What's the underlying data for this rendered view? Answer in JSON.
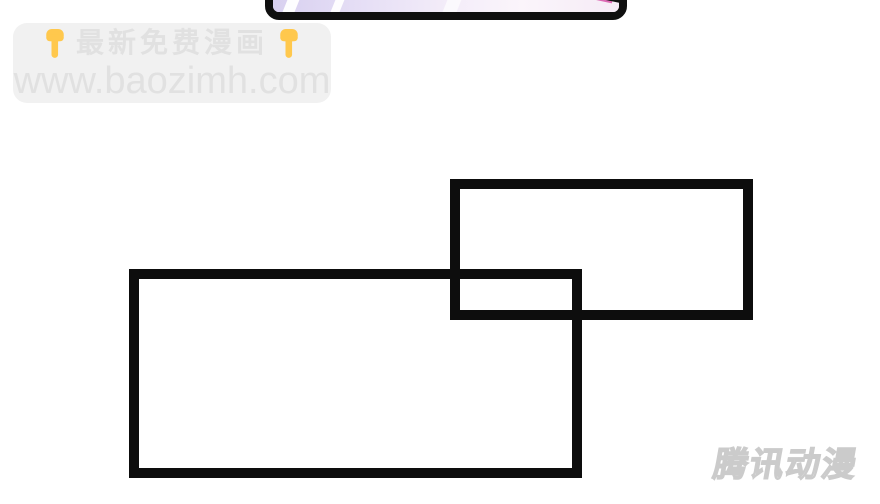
{
  "page": {
    "background_color": "#ffffff",
    "content_type": "manhua-comic-page"
  },
  "top_panel": {
    "description": "partially visible comic panel cropped by top edge",
    "border_color": "#0f0f0f",
    "art_colors": {
      "lavender": "#d8d0f0",
      "pale_pink": "#fbf5fb",
      "stripe_white": "#ffffff",
      "accent_pink": "#dc6ab4",
      "wedge_black": "#101010"
    }
  },
  "promo_banner": {
    "background_color": "#f1f1f1",
    "text_color": "#e1e1e1",
    "left_icon": "point-down-hand",
    "right_icon": "point-down-hand",
    "hand_color": "#ffc84d",
    "headline": "最新免费漫画",
    "url": "www.baozimh.com"
  },
  "comic_frames": {
    "border_color": "#0d0d0d",
    "right_frame_content": "",
    "left_frame_content": ""
  },
  "publisher_watermark": {
    "text": "腾讯动漫",
    "color": "#d0d0d0"
  }
}
